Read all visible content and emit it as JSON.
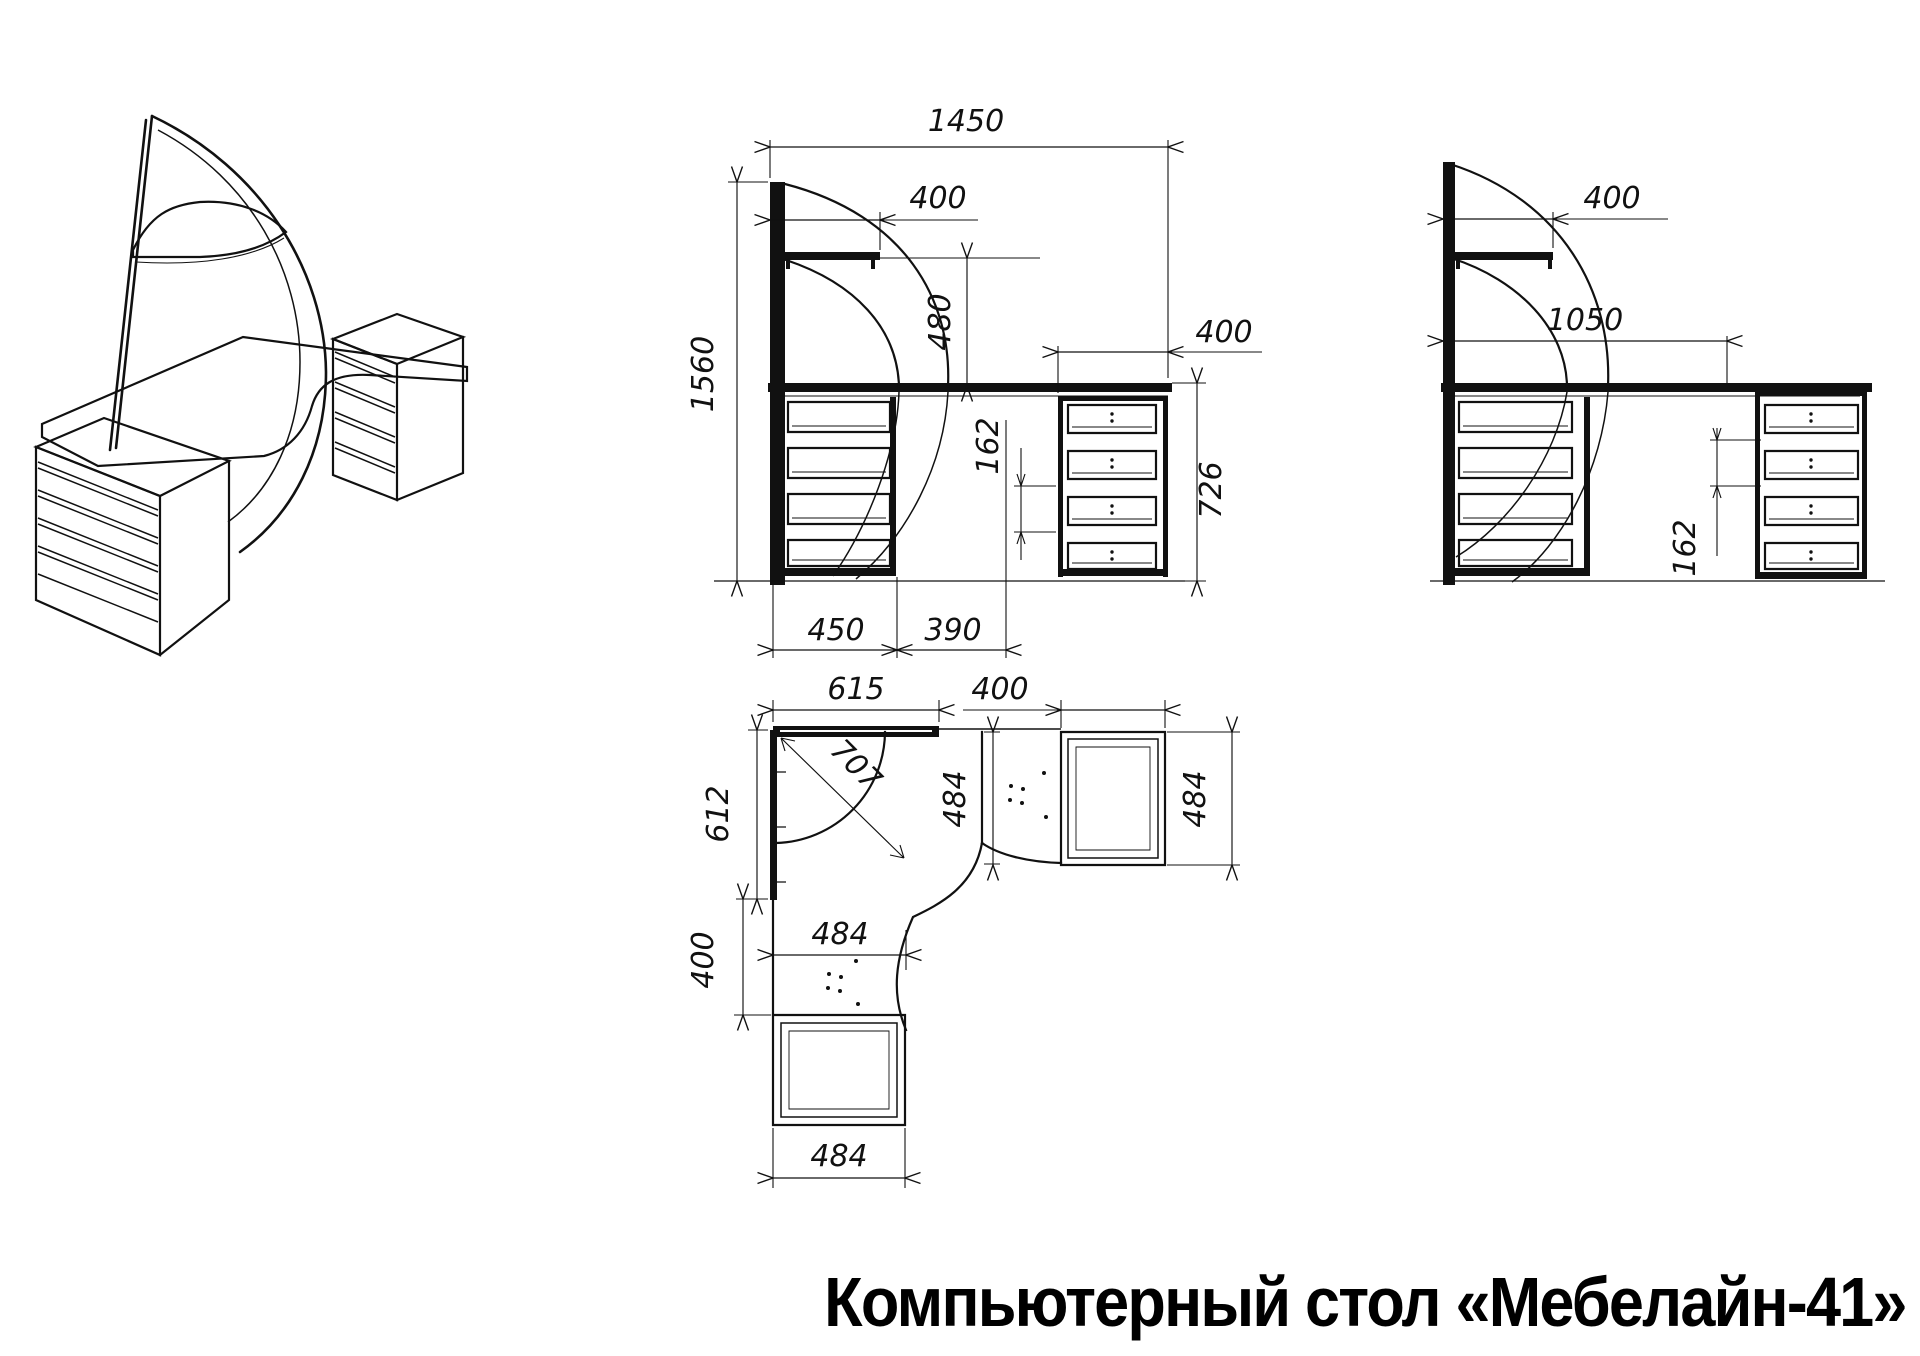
{
  "title": "Компьютерный стол «Мебелайн-41»",
  "colors": {
    "line": "#111111",
    "background": "#ffffff"
  },
  "views": {
    "front": {
      "name": "front-elevation",
      "dims": {
        "total_width": "1450",
        "shelf_width": "400",
        "shelf_to_desk": "480",
        "total_height": "1560",
        "pedestal_width": "400",
        "drawer_pitch": "162",
        "pedestal_height": "726",
        "left_pedestal_width": "450",
        "gap": "390"
      }
    },
    "side": {
      "name": "side-elevation",
      "dims": {
        "shelf_depth": "400",
        "desk_length": "1050",
        "drawer_pitch": "162"
      }
    },
    "plan": {
      "name": "top-plan",
      "dims": {
        "back_width": "615",
        "unit_width": "400",
        "left_depth": "612",
        "diagonal": "707",
        "return_depth": "484",
        "unit_depth": "484",
        "lower_gap": "400",
        "cutout_width": "484",
        "bottom_unit_width": "484"
      }
    }
  }
}
